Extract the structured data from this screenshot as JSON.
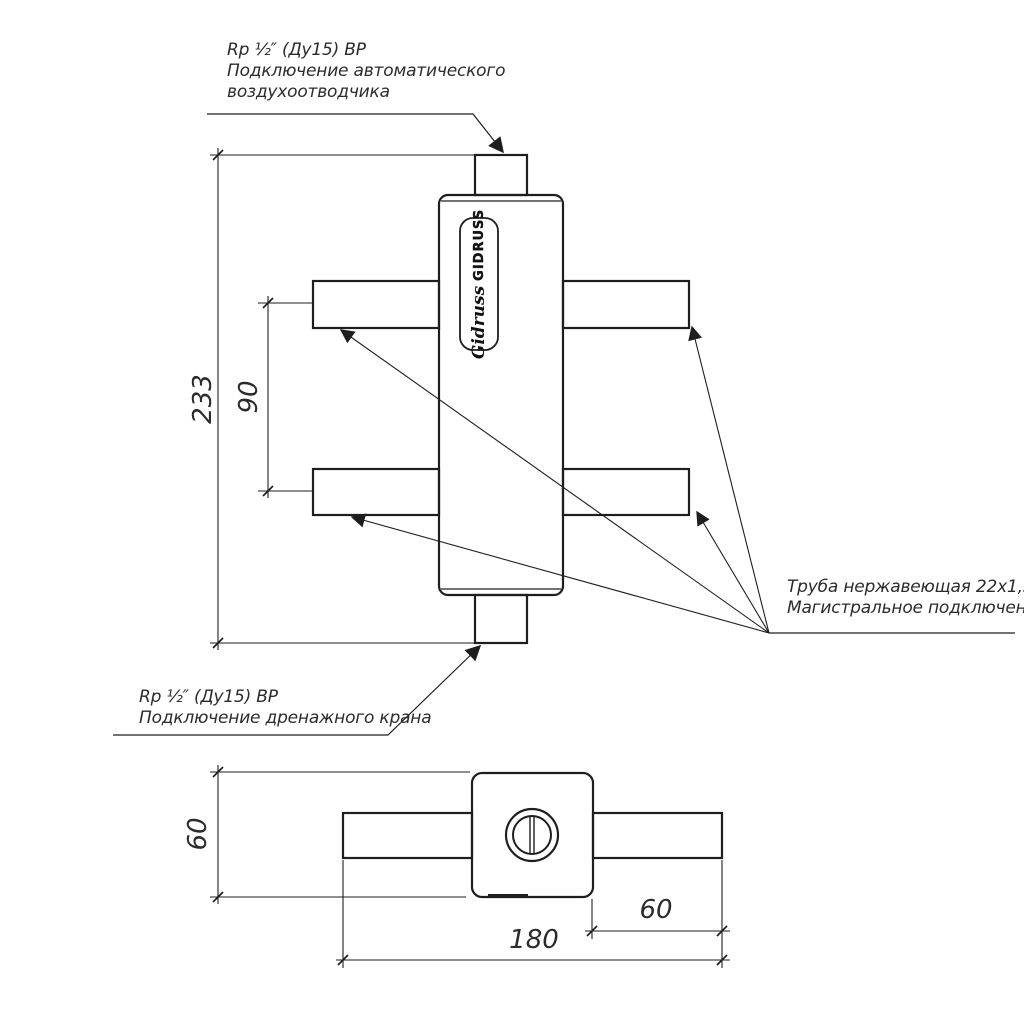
{
  "top_note": {
    "l1": "Rp ½″ (Ду15) ВР",
    "l2": "Подключение автоматического",
    "l3": "воздухоотводчика"
  },
  "drain_note": {
    "l1": "Rp ½″ (Ду15) ВР",
    "l2": "Подключение дренажного крана"
  },
  "pipe_note": {
    "l1": "Труба нержавеющая 22х1,5м",
    "l2": "Магистральное подключение"
  },
  "dims": {
    "overall_height": "233",
    "port_spacing": "90",
    "plan_depth": "60",
    "plan_stub": "60",
    "plan_length": "180"
  },
  "logo": {
    "script": "Gidruss",
    "caps": "GIDRUSS"
  },
  "colors": {
    "background": "#ffffff",
    "line": "#1e1e1e",
    "text": "#2b2b2b"
  }
}
